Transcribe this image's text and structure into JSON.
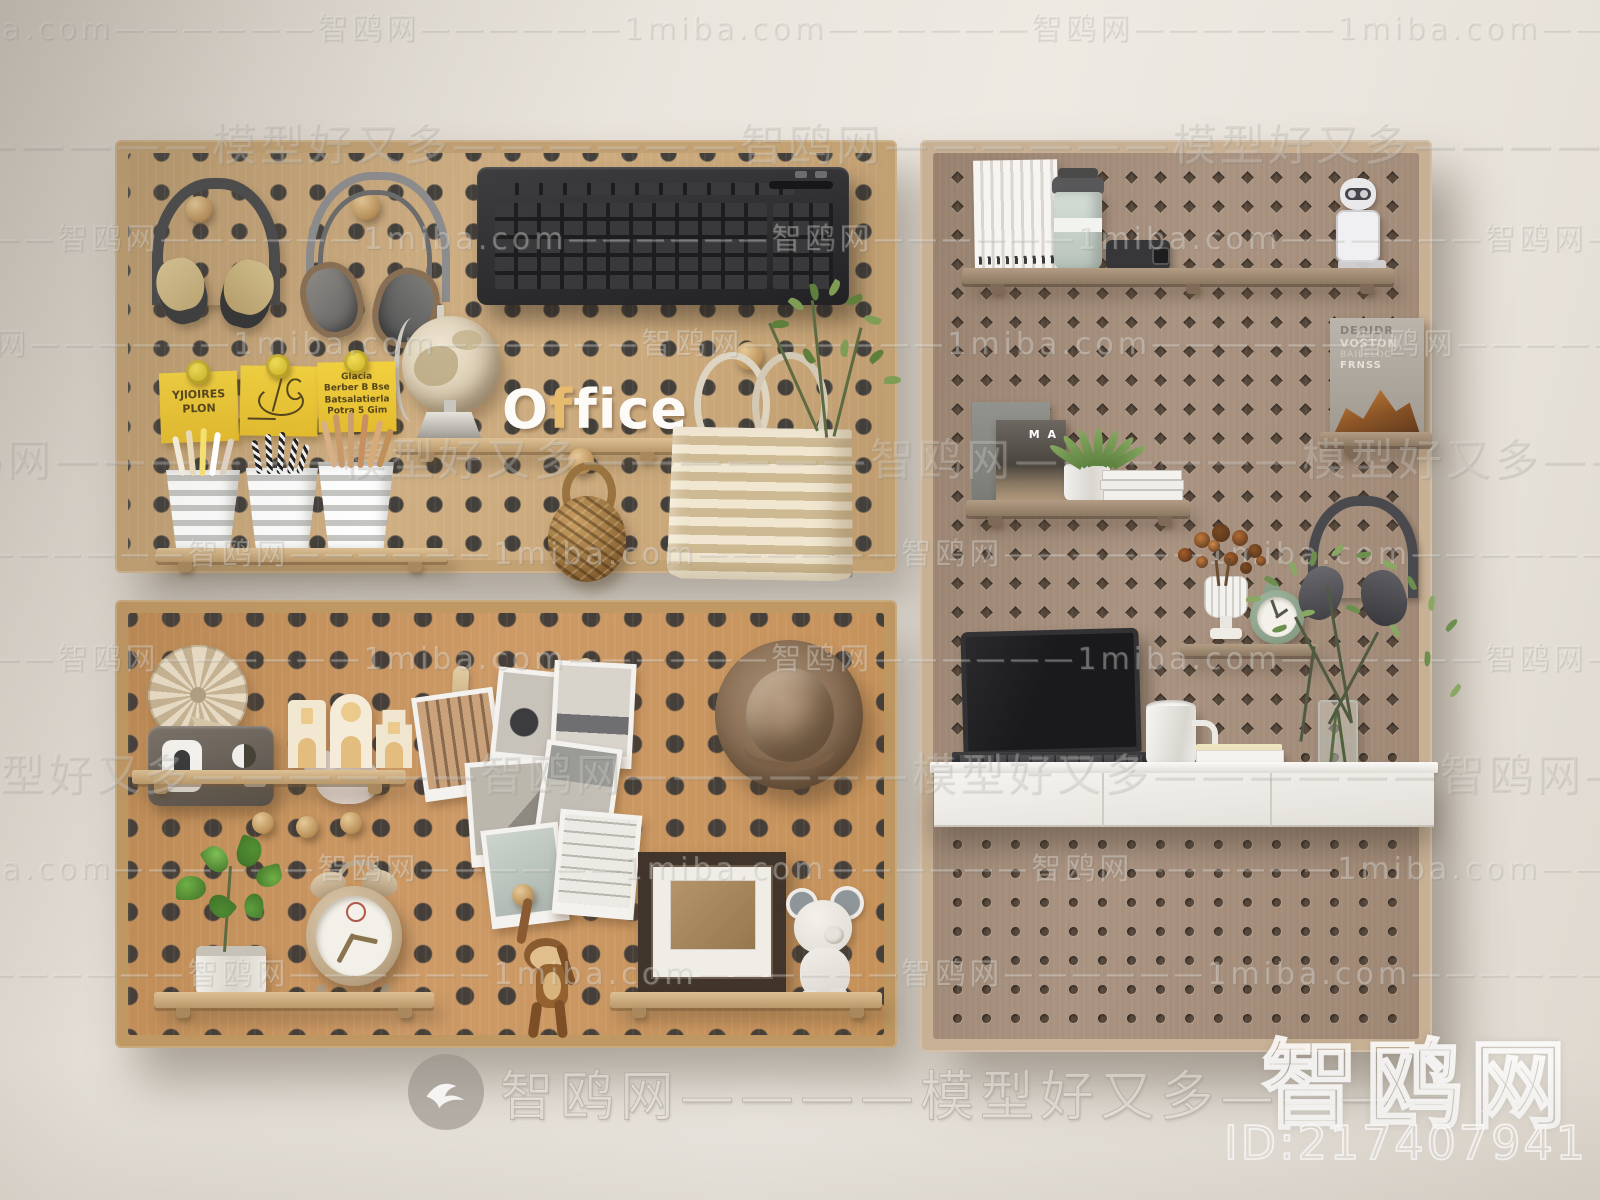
{
  "meta": {
    "scene_title": "Wall-mounted pegboard organizer set with office accessories (3D render)"
  },
  "colors": {
    "wall": "#e9e4dd",
    "board_oak": "#c9a87b",
    "board_cork": "#c9905c",
    "board_taupe": "#a18b78",
    "accent_yellow": "#f0cd3a",
    "desk_white": "#f2f0ec",
    "keyboard_black": "#2e2e30"
  },
  "office_sign": {
    "o": "O",
    "f_accent": "f",
    "rest": "fice"
  },
  "sticky_notes": {
    "note1_line1": "YJlOIRES",
    "note1_line2": "PLON",
    "note3_line1": "Glacia",
    "note3_line2": "Berber B Bse",
    "note3_line3": "Batsalatierla",
    "note3_line4": "Potra 5 Gim"
  },
  "books": {
    "dark_cover_title": "M A",
    "right_book_line1": "DEOIDR",
    "right_book_line2": "VOSTON",
    "right_book_line3": "BAILELOC",
    "right_book_line4": "FRNSS"
  },
  "watermarks": {
    "site": "智鸥网",
    "domain": "1miba.com",
    "slogan": "模型好又多",
    "dashes": "——————",
    "footer_text": "智鸥网————模型好又多————",
    "corner_site": "智鸥网",
    "image_id": "ID:217407941"
  }
}
